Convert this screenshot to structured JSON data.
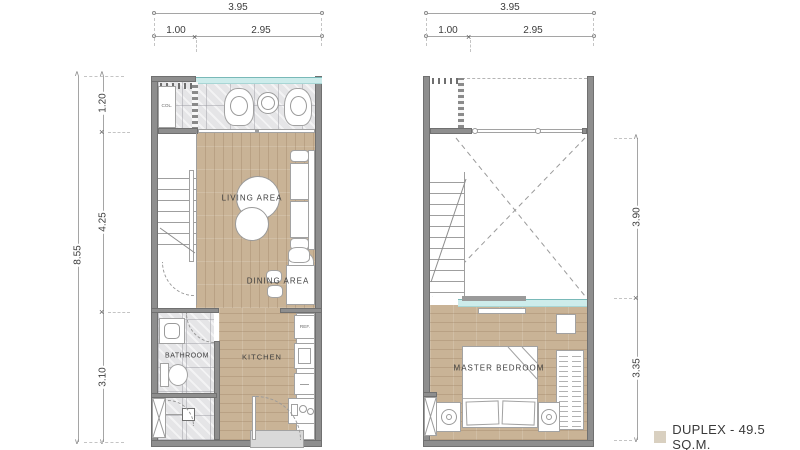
{
  "floor1": {
    "dim_width_total": "3.95",
    "dim_width_left": "1.00",
    "dim_width_right": "2.95",
    "dim_height_total": "8.55",
    "dim_height_top": "1.20",
    "dim_height_mid": "4.25",
    "dim_height_bottom": "3.10",
    "rooms": {
      "living_area": "LIVING AREA",
      "dining_area": "DINING AREA",
      "bathroom": "BATHROOM",
      "kitchen": "KITCHEN"
    },
    "fixtures": {
      "closet": "COL.",
      "fridge": "REF."
    }
  },
  "floor2": {
    "dim_width_total": "3.95",
    "dim_width_left": "1.00",
    "dim_width_right": "2.95",
    "dim_height_top": "3.90",
    "dim_height_bottom": "3.35",
    "rooms": {
      "master_bedroom": "MASTER BEDROOM"
    }
  },
  "legend": {
    "label": "DUPLEX - 49.5 SQ.M."
  },
  "colors": {
    "wall": "#8e8e8e",
    "wood": "#c9b396",
    "marble": "#e5e5e7",
    "glass": "#cdeceb",
    "legend_swatch": "#d9d0c0"
  }
}
